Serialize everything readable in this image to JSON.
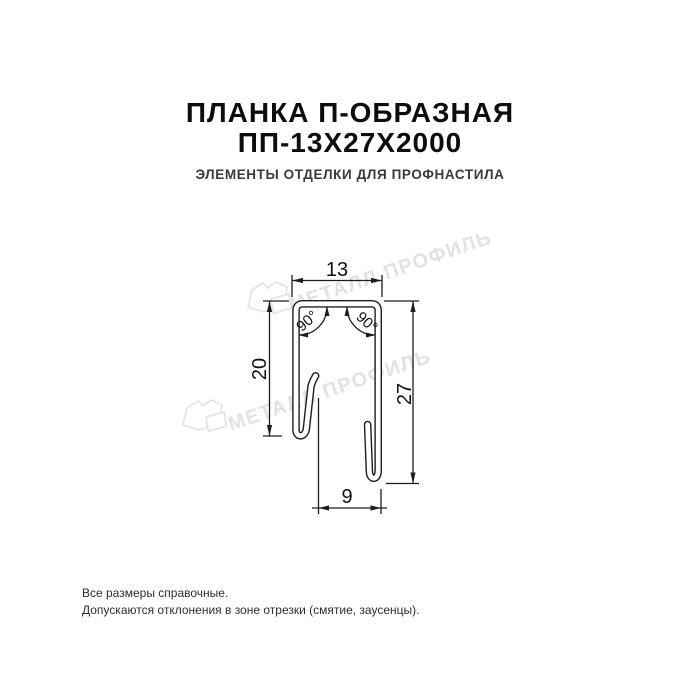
{
  "header": {
    "title_line1": "ПЛАНКА П-ОБРАЗНАЯ",
    "title_line2": "ПП-13Х27Х2000",
    "subtitle": "ЭЛЕМЕНТЫ ОТДЕЛКИ ДЛЯ ПРОФНАСТИЛА"
  },
  "drawing": {
    "dimensions": {
      "top_width": "13",
      "left_height": "20",
      "right_height": "27",
      "bottom_width": "9",
      "angle_left": "90°",
      "angle_right": "90°"
    },
    "watermark": {
      "text": "МЕТАЛЛ ПРОФИЛЬ"
    },
    "colors": {
      "background": "#ffffff",
      "title": "#0d0d0d",
      "subtitle": "#3a3a3a",
      "drawing_line": "#1d1d1d",
      "watermark": "#e2e2e2"
    }
  },
  "footer": {
    "line1": "Все размеры справочные.",
    "line2": "Допускаются отклонения в зоне отрезки (смятие, заусенцы)."
  }
}
